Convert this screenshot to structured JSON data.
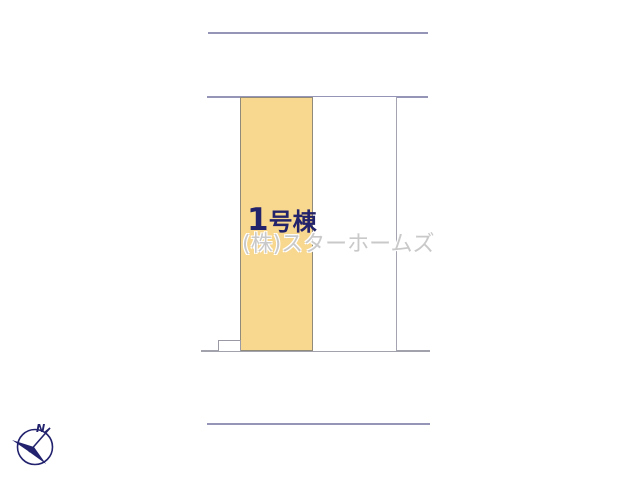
{
  "site_plan": {
    "title": "site layout plan",
    "lots": [
      {
        "id": "lot-1",
        "label_number": "1",
        "label_suffix": "号棟",
        "highlighted": true,
        "fill": "#f8d78e"
      },
      {
        "id": "lot-2",
        "label": "",
        "highlighted": false,
        "fill": "#ffffff"
      }
    ],
    "watermark": "(株)スターホームズ",
    "compass": {
      "label": "N"
    },
    "colors": {
      "road_line": "#9595b8",
      "plot_bottom_line": "#a2a2ac",
      "lot_border": "#8f8a7a",
      "highlight_fill": "#f8d78e",
      "label_text": "#23236b",
      "watermark_text": "#c9c9c9",
      "compass": "#22226e",
      "background": "#ffffff"
    }
  }
}
